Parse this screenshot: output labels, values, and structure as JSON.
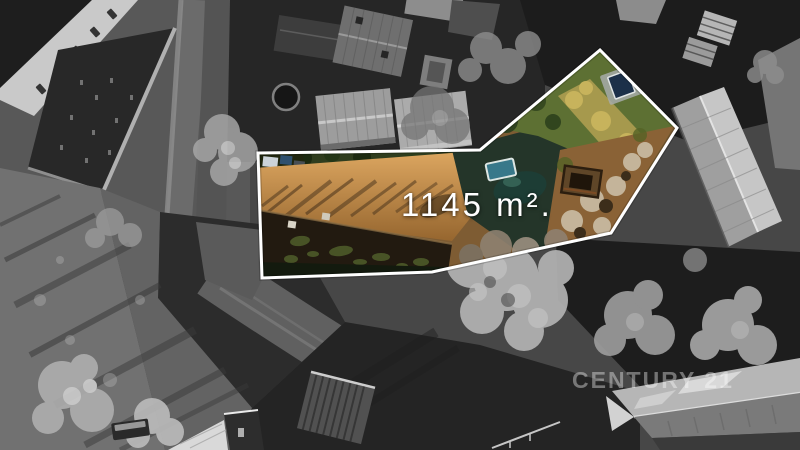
{
  "overlay": {
    "area_label": "1145 m².",
    "outline_color": "#ffffff",
    "label_color": "#ffffff"
  },
  "watermark": {
    "text": "CENTURY 21",
    "color": "#ffffff",
    "opacity": 0.38
  },
  "scene": {
    "palette": {
      "surroundings_gray": "#4a4a4a",
      "highlight_meadow_orange": "#c08c4a",
      "plot_roof_dark": "#221a10",
      "garden_green": "#5d7033",
      "pool_teal": "#38788a",
      "pool_navy": "#1c3049",
      "shed_brown": "#5f4628"
    }
  }
}
